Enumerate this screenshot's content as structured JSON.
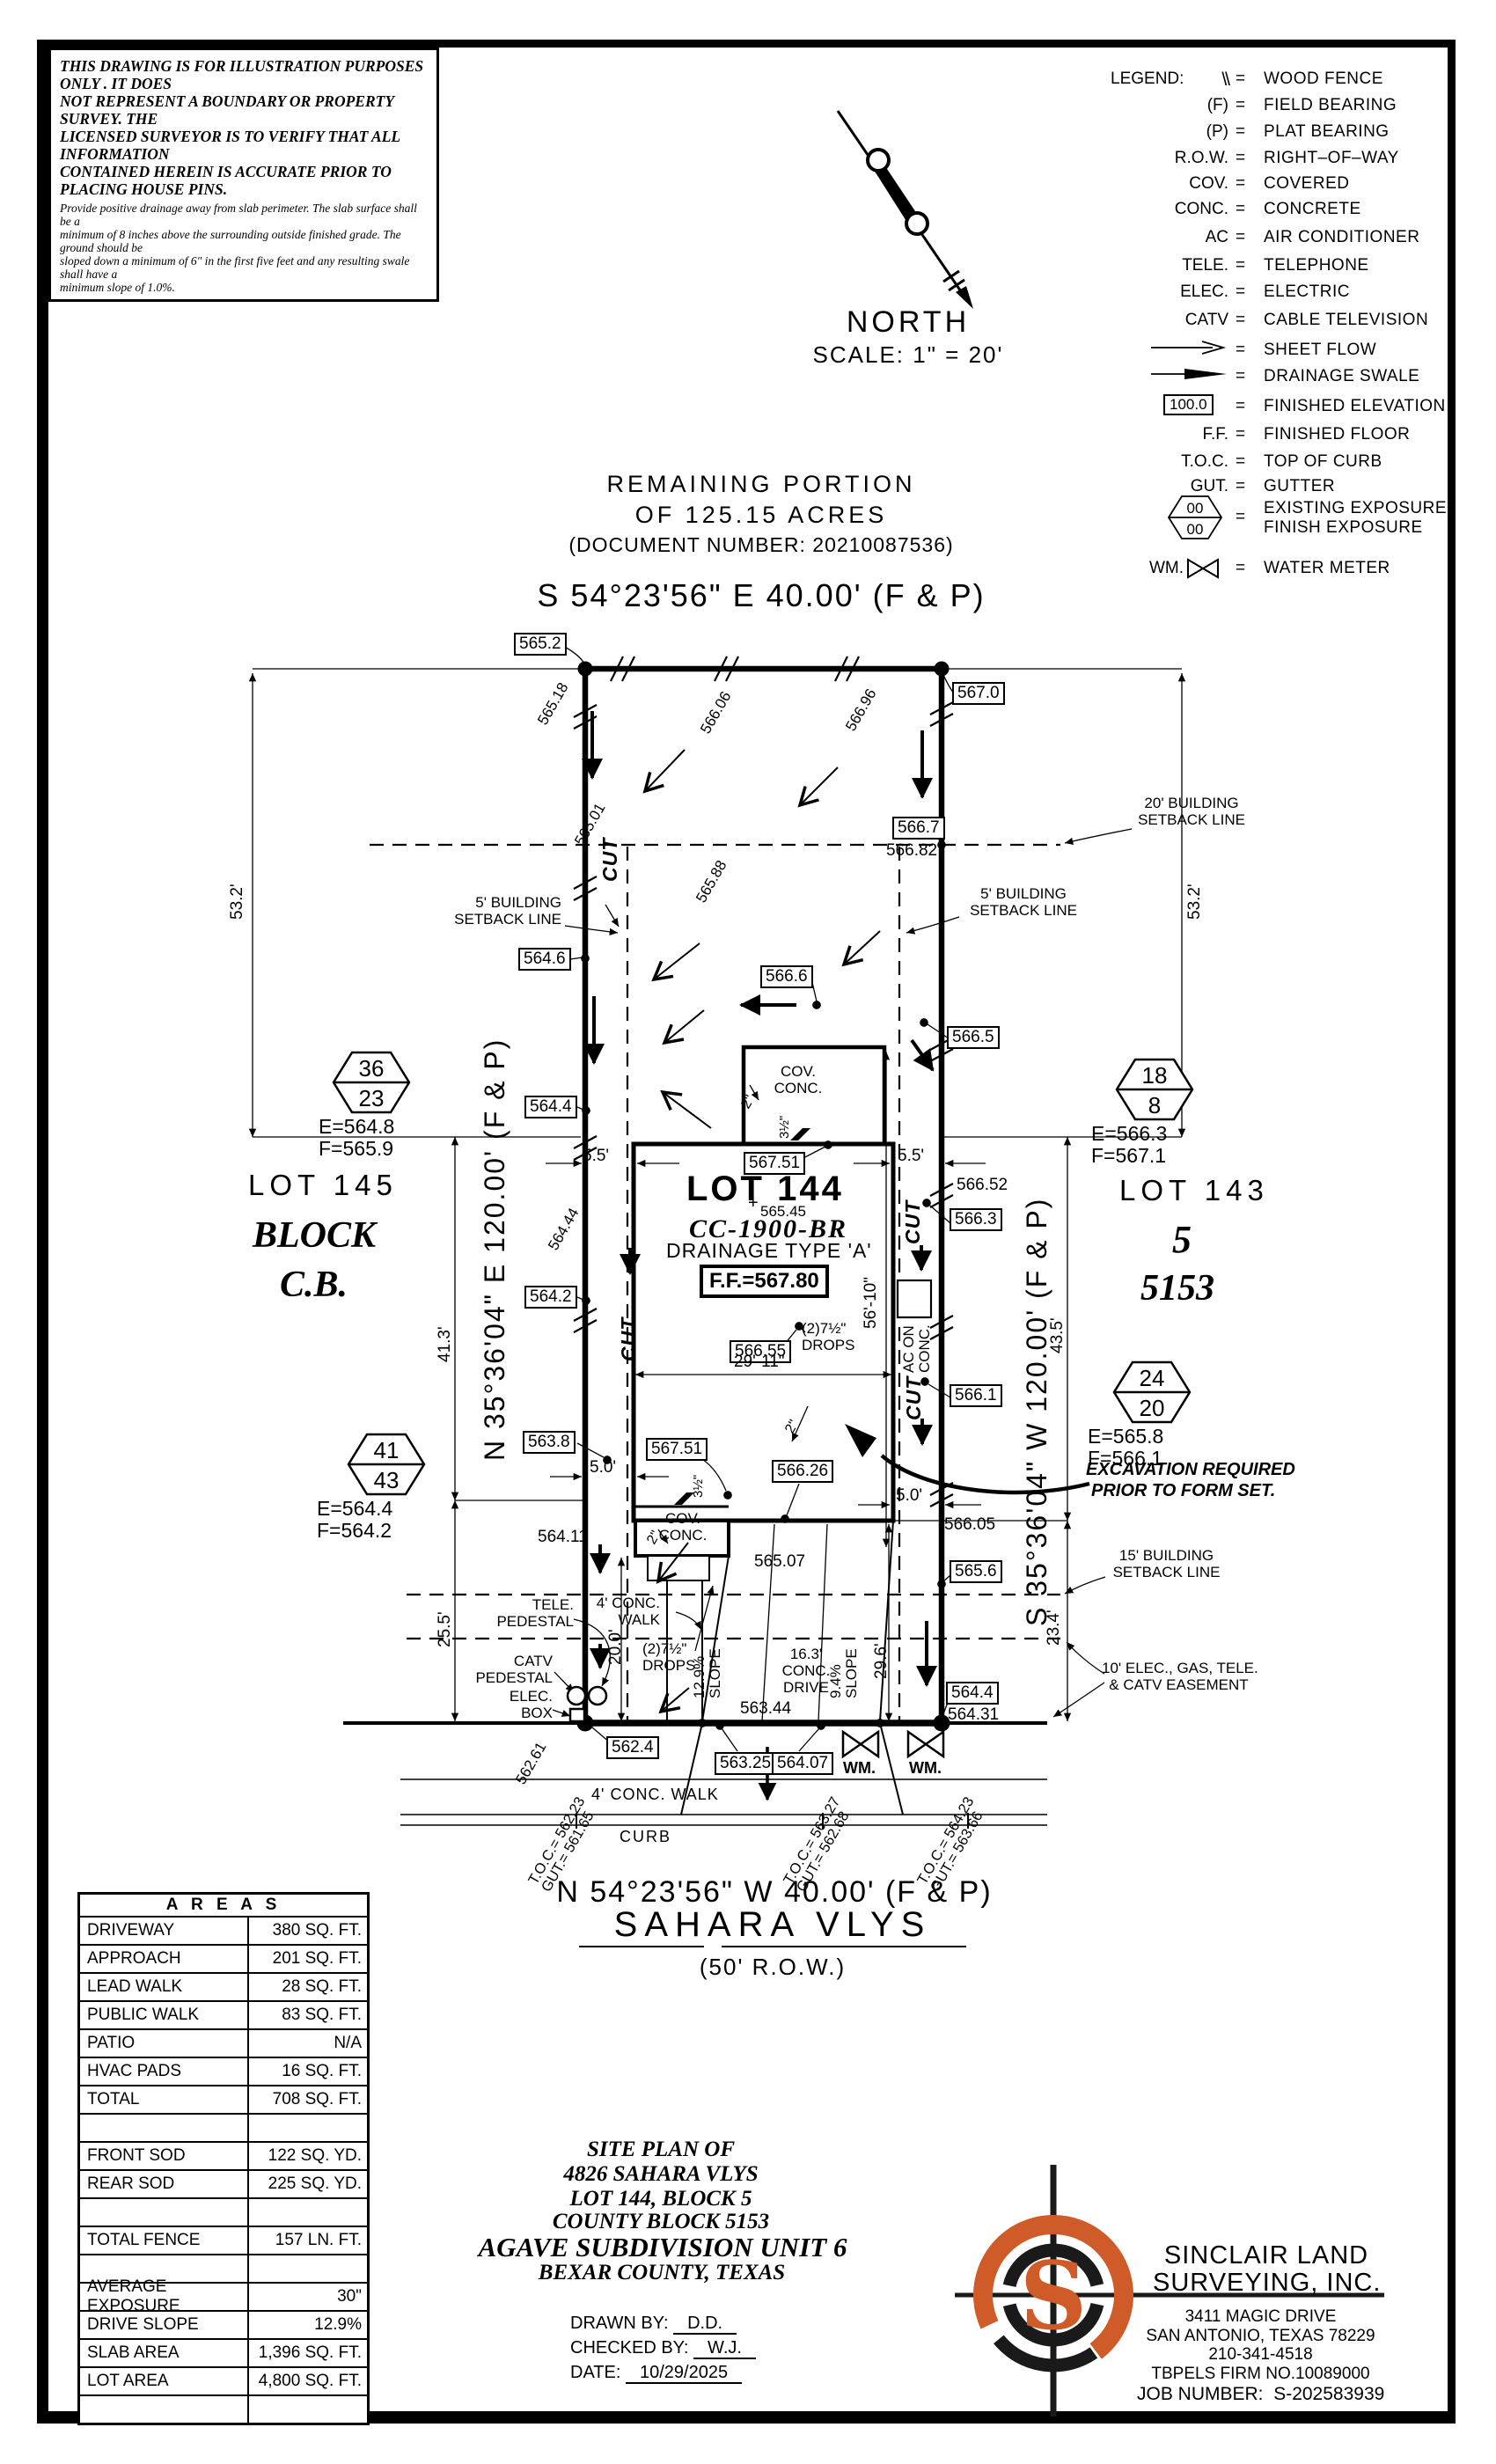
{
  "disclaimer": {
    "l1": "THIS DRAWING IS FOR ILLUSTRATION PURPOSES ONLY . IT DOES",
    "l2": "NOT REPRESENT A BOUNDARY OR PROPERTY SURVEY. THE",
    "l3": "LICENSED SURVEYOR IS TO VERIFY THAT ALL INFORMATION",
    "l4": "CONTAINED HEREIN IS ACCURATE PRIOR TO PLACING HOUSE PINS.",
    "n1": "Provide positive drainage away from slab perimeter. The slab surface shall be a",
    "n2": "minimum of 8 inches above the surrounding outside finished grade. The ground should be",
    "n3": "sloped down a minimum of 6\" in the first five feet and any resulting swale shall have a",
    "n4": "minimum slope of 1.0%."
  },
  "north": {
    "label": "NORTH",
    "scale": "SCALE: 1\" = 20'"
  },
  "legend": {
    "title": "LEGEND:",
    "eq": "=",
    "rows": [
      {
        "sym": "\\\\",
        "desc": "WOOD FENCE"
      },
      {
        "sym": "(F)",
        "desc": "FIELD BEARING"
      },
      {
        "sym": "(P)",
        "desc": "PLAT BEARING"
      },
      {
        "sym": "R.O.W.",
        "desc": "RIGHT–OF–WAY"
      },
      {
        "sym": "COV.",
        "desc": "COVERED"
      },
      {
        "sym": "CONC.",
        "desc": "CONCRETE"
      },
      {
        "sym": "AC",
        "desc": "AIR CONDITIONER"
      },
      {
        "sym": "TELE.",
        "desc": "TELEPHONE"
      },
      {
        "sym": "ELEC.",
        "desc": "ELECTRIC"
      },
      {
        "sym": "CATV",
        "desc": "CABLE TELEVISION"
      },
      {
        "sym": "",
        "desc": "SHEET FLOW"
      },
      {
        "sym": "",
        "desc": "DRAINAGE SWALE"
      },
      {
        "sym": "100.0",
        "desc": "FINISHED ELEVATION"
      },
      {
        "sym": "F.F.",
        "desc": "FINISHED FLOOR"
      },
      {
        "sym": "T.O.C.",
        "desc": "TOP OF CURB"
      },
      {
        "sym": "GUT.",
        "desc": "GUTTER"
      },
      {
        "sym": "00",
        "sym2": "00",
        "desc": "EXISTING EXPOSURE",
        "desc2": "FINISH EXPOSURE"
      },
      {
        "sym": "WM.",
        "desc": "WATER METER"
      }
    ]
  },
  "header": {
    "rem1": "REMAINING PORTION",
    "rem2": "OF 125.15 ACRES",
    "doc": "(DOCUMENT NUMBER: 20210087536)",
    "bearing": "S 54°23'56\" E 40.00' (F & P)"
  },
  "sides": {
    "left_bearing": "N 35°36'04\" E 120.00' (F & P)",
    "right_bearing": "S 35°36'04\" W 120.00' (F & P)"
  },
  "street": {
    "bearing_n": "N 54°23'56\" W 40.00' (F & P)",
    "name": "SAHARA VLYS",
    "row": "(50' R.O.W.)",
    "curb": "CURB",
    "walk": "4' CONC. WALK",
    "walk_1": "4' CONC.",
    "walk_2": "WALK"
  },
  "lots": {
    "left_lot": "LOT 145",
    "left_block": "BLOCK",
    "left_cb": "C.B.",
    "right_lot": "LOT 143",
    "right_block": "5",
    "right_cb": "5153"
  },
  "house": {
    "lot": "LOT 144",
    "model": "CC-1900-BR",
    "drainage": "DRAINAGE TYPE 'A'",
    "plus": "+",
    "cov": "COV.",
    "conc": "CONC.",
    "drops_qty": "(2)7½\"",
    "drops": "DROPS",
    "ac_1": "AC ON",
    "ac_2": "CONC.",
    "cut": "CUT"
  },
  "elev": {
    "b565_2": "565.2",
    "b567_0": "567.0",
    "b566_7": "566.7",
    "b564_6": "564.6",
    "b566_6": "566.6",
    "b566_5": "566.5",
    "b564_4": "564.4",
    "b567_51": "567.51",
    "b566_3": "566.3",
    "b564_2": "564.2",
    "b566_55": "566.55",
    "b566_1": "566.1",
    "b563_8": "563.8",
    "b566_26": "566.26",
    "b565_6": "565.6",
    "b562_4": "562.4",
    "b563_25": "563.25",
    "b564_07": "564.07",
    "ff": "F.F.=567.80",
    "f566_82": "566.82",
    "f566_52": "566.52",
    "f564_11": "564.11",
    "f565_07": "565.07",
    "f566_05": "566.05",
    "f564_31": "564.31",
    "f563_44": "563.44",
    "f565_45": "565.45",
    "r565_18": "565.18",
    "r566_06": "566.06",
    "r566_96": "566.96",
    "r565_01": "565.01",
    "r565_88": "565.88",
    "r564_44": "564.44",
    "r562_61": "562.61"
  },
  "dims": {
    "d5_5": "5.5'",
    "d5_0": "5.0'",
    "d53_2": "53.2'",
    "d41_3": "41.3'",
    "d25_5": "25.5'",
    "d20_0": "20.0'",
    "d29_6": "29.6'",
    "d23_4": "23.4'",
    "d43_5": "43.5'",
    "d29_11": "29'-11\"",
    "d56_10": "56'-10\"",
    "d16_3": "16.3'",
    "conc": "CONC.",
    "drive": "DRIVE",
    "s12_9": "12.9%",
    "s9_4": "9.4%",
    "slope": "SLOPE",
    "d2": "2\"",
    "d3_5": "3½\""
  },
  "setbacks": {
    "s20": "20' BUILDING",
    "s5": "5' BUILDING",
    "s15": "15' BUILDING",
    "line": "SETBACK LINE",
    "e1": "10' ELEC., GAS, TELE.",
    "e2": "& CATV EASEMENT"
  },
  "markers": {
    "m1_top": "36",
    "m1_bot": "23",
    "m1_e": "E=564.8",
    "m1_f": "F=565.9",
    "m2_top": "18",
    "m2_bot": "8",
    "m2_e": "E=566.3",
    "m2_f": "F=567.1",
    "m3_top": "41",
    "m3_bot": "43",
    "m3_e": "E=564.4",
    "m3_f": "F=564.2",
    "m4_top": "24",
    "m4_bot": "20",
    "m4_e": "E=565.8",
    "m4_f": "F=566.1"
  },
  "notes": {
    "exc_1": "EXCAVATION REQUIRED",
    "exc_2": "PRIOR TO FORM SET.",
    "tele_1": "TELE.",
    "tele_2": "PEDESTAL",
    "catv_1": "CATV",
    "catv_2": "PEDESTAL",
    "elec_1": "ELEC.",
    "elec_2": "BOX",
    "wm": "WM."
  },
  "toc": {
    "t1": "T.O.C.= 562.23",
    "g1": "GUT.= 561.65",
    "t2": "T.O.C.= 563.27",
    "g2": "GUT.= 562.68",
    "t3": "T.O.C.= 564.23",
    "g3": "GUT.= 563.66"
  },
  "areas": {
    "title": "A R E A S",
    "rows": [
      [
        "DRIVEWAY",
        "380 SQ. FT."
      ],
      [
        "APPROACH",
        "201 SQ. FT."
      ],
      [
        "LEAD WALK",
        "28 SQ. FT."
      ],
      [
        "PUBLIC WALK",
        "83 SQ. FT."
      ],
      [
        "PATIO",
        "N/A"
      ],
      [
        "HVAC PADS",
        "16 SQ. FT."
      ],
      [
        "TOTAL",
        "708 SQ. FT."
      ],
      [
        "",
        ""
      ],
      [
        "FRONT SOD",
        "122 SQ. YD."
      ],
      [
        "REAR SOD",
        "225 SQ. YD."
      ],
      [
        "",
        ""
      ],
      [
        "TOTAL FENCE",
        "157 LN. FT."
      ],
      [
        "",
        ""
      ],
      [
        "AVERAGE EXPOSURE",
        "30\""
      ],
      [
        "DRIVE SLOPE",
        "12.9%"
      ],
      [
        "SLAB AREA",
        "1,396 SQ. FT."
      ],
      [
        "LOT AREA",
        "4,800 SQ. FT."
      ],
      [
        "",
        ""
      ]
    ]
  },
  "titleblock": {
    "t1": "SITE PLAN OF",
    "t2": "4826 SAHARA VLYS",
    "t3": "LOT 144, BLOCK 5",
    "t4": "COUNTY BLOCK 5153",
    "t5": "AGAVE SUBDIVISION UNIT 6",
    "t6": "BEXAR COUNTY, TEXAS",
    "drawn_label": "DRAWN BY:",
    "drawn": "D.D.",
    "checked_label": "CHECKED BY:",
    "checked": "W.J.",
    "date_label": "DATE:",
    "date": "10/29/2025"
  },
  "firm": {
    "name1": "SINCLAIR LAND",
    "name2": "SURVEYING, INC.",
    "addr1": "3411 MAGIC DRIVE",
    "addr2": "SAN ANTONIO, TEXAS 78229",
    "phone": "210-341-4518",
    "tbpels": "TBPELS FIRM NO.10089000",
    "job_label": "JOB NUMBER:",
    "job": "S-202583939",
    "logo_s": "S"
  },
  "colors": {
    "accent": "#cf5b28",
    "ink": "#000000"
  }
}
